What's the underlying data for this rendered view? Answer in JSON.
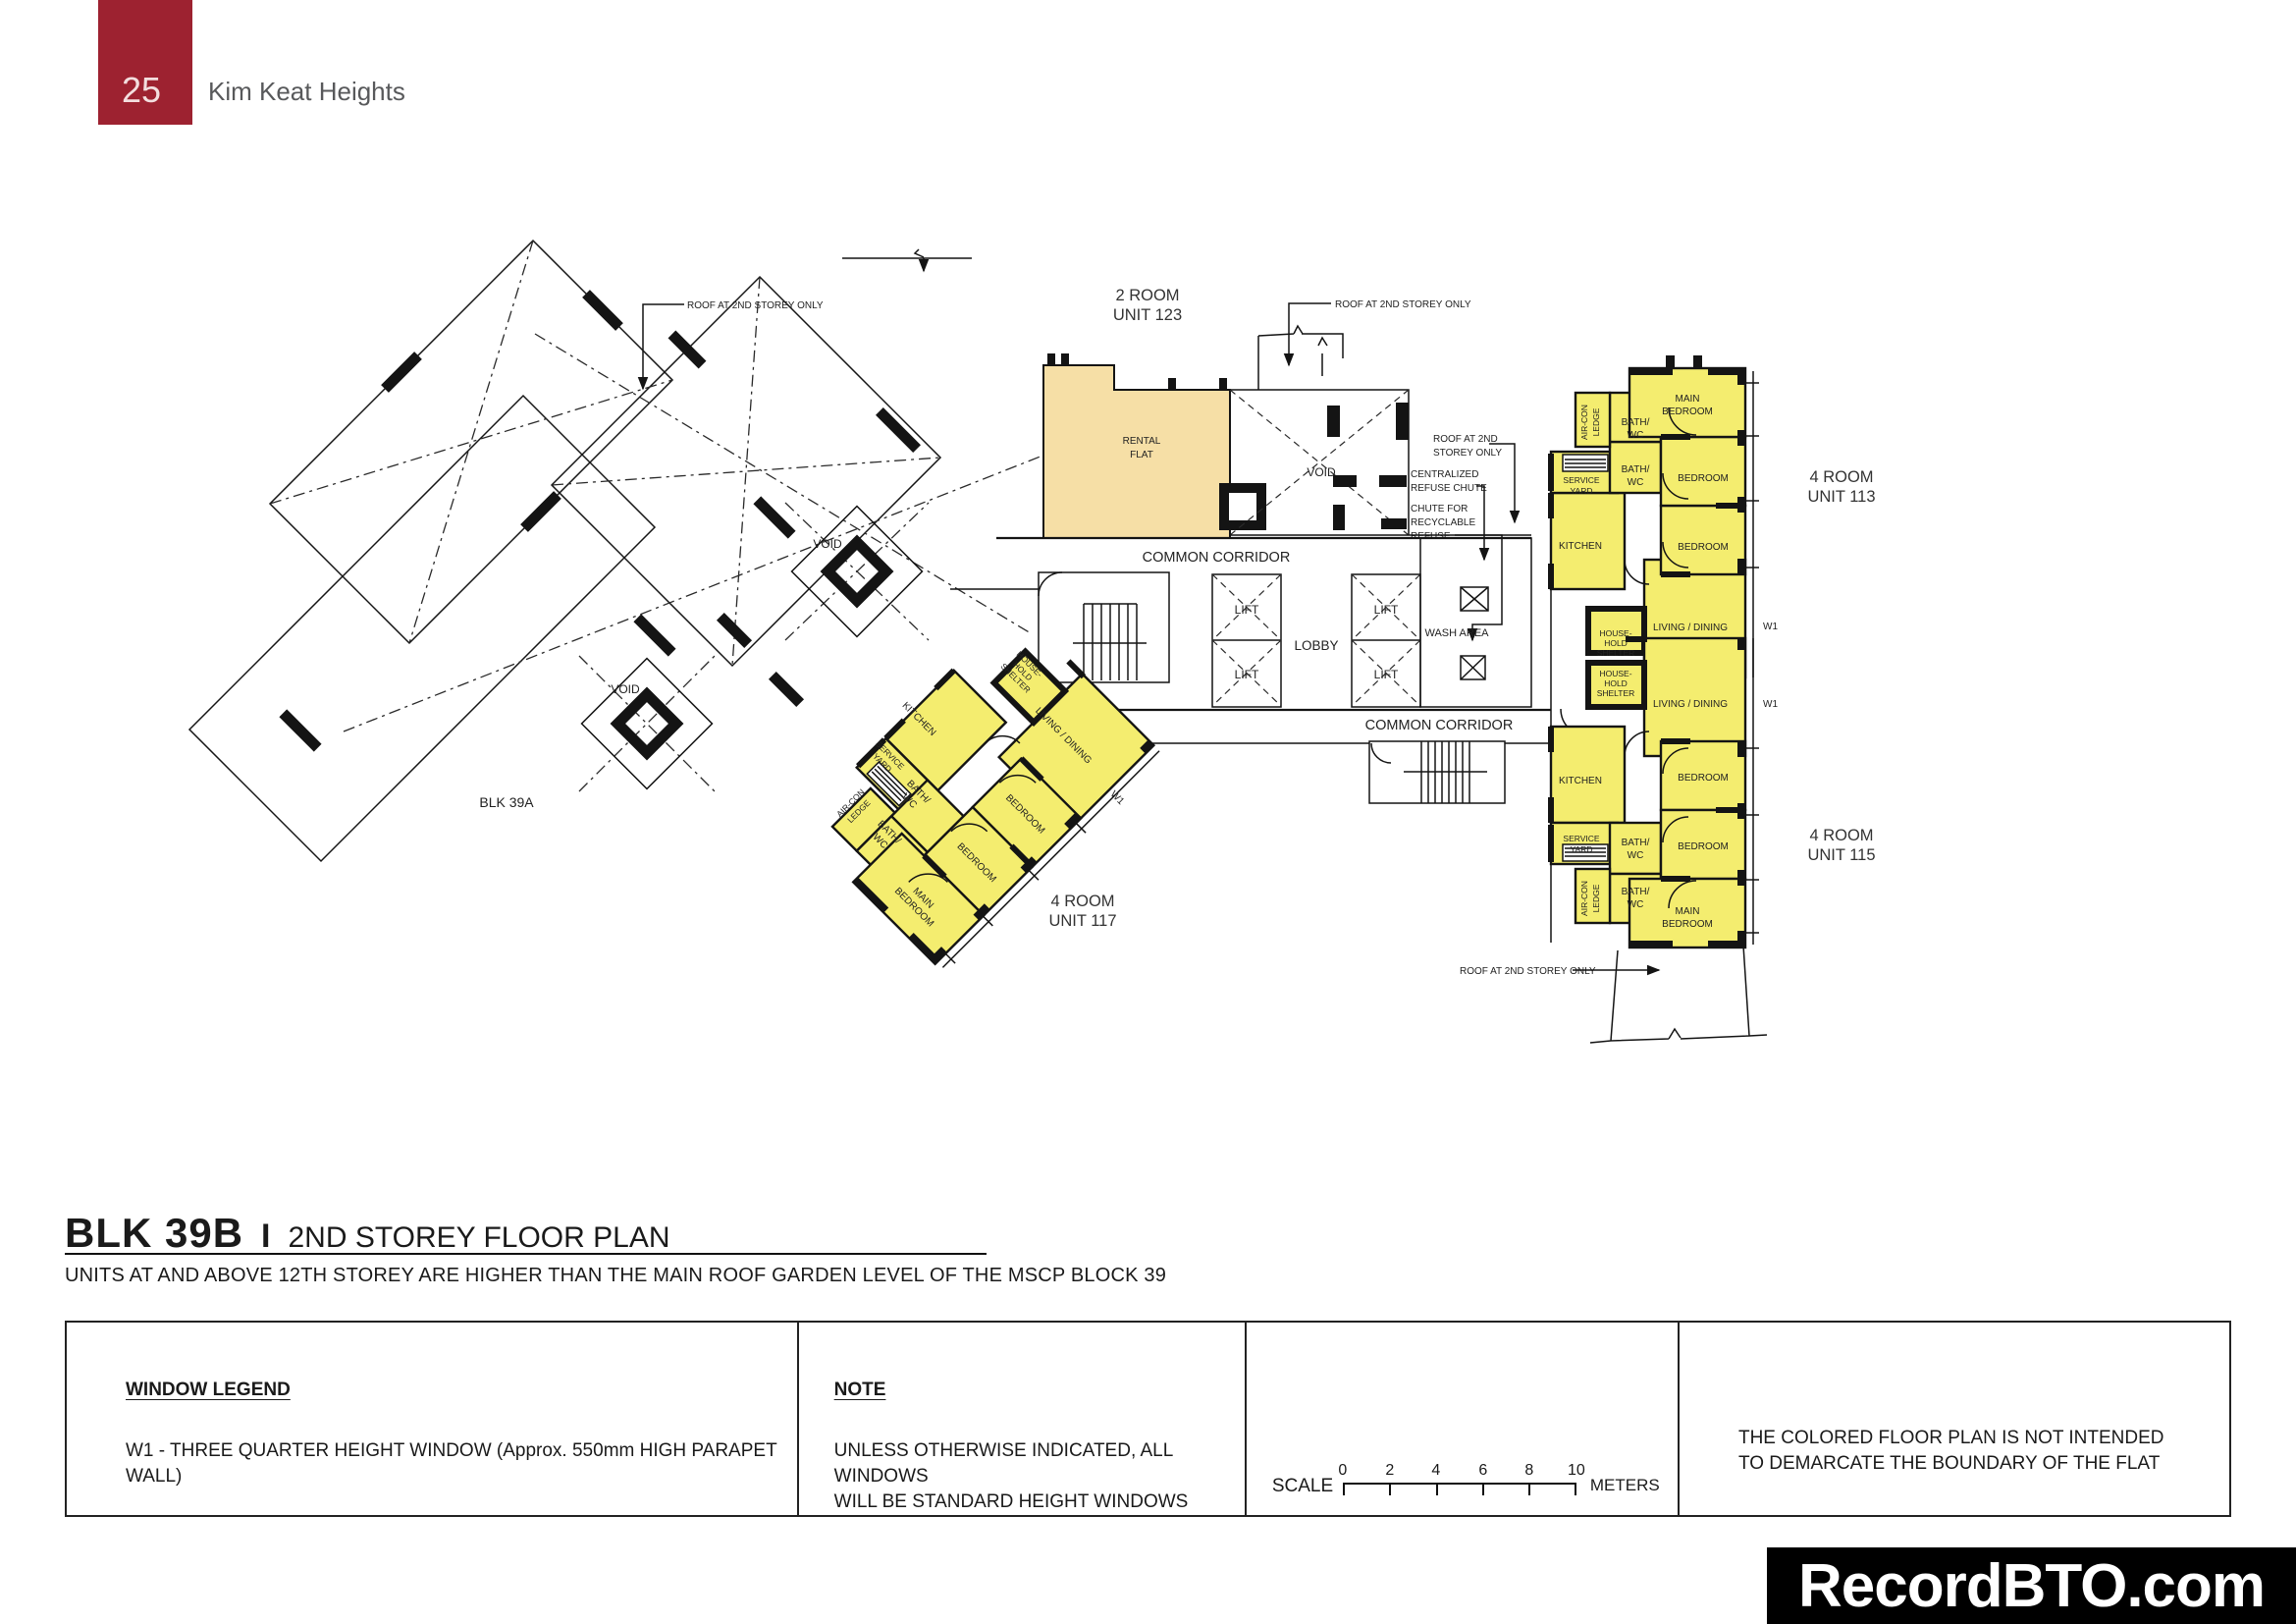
{
  "page": {
    "number": "25",
    "project": "Kim Keat Heights"
  },
  "title": {
    "block": "BLK 39B",
    "separator": "I",
    "storey": "2ND STOREY FLOOR PLAN",
    "note": "UNITS AT AND ABOVE 12TH STOREY ARE HIGHER THAN THE MAIN ROOF GARDEN LEVEL OF THE MSCP BLOCK 39"
  },
  "units": {
    "u123_l1": "2 ROOM",
    "u123_l2": "UNIT 123",
    "u113_l1": "4 ROOM",
    "u113_l2": "UNIT 113",
    "u115_l1": "4 ROOM",
    "u115_l2": "UNIT 115",
    "u117_l1": "4 ROOM",
    "u117_l2": "UNIT 117"
  },
  "rooms": {
    "main_l1": "MAIN",
    "main_l2": "BEDROOM",
    "bedroom": "BEDROOM",
    "bath_l1": "BATH/",
    "bath_l2": "WC",
    "kitchen": "KITCHEN",
    "service_l1": "SERVICE",
    "service_l2": "YARD",
    "aircon_l1": "AIR-CON",
    "aircon_l2": "LEDGE",
    "living": "LIVING / DINING",
    "hhs_l1": "HOUSE-",
    "hhs_l2": "HOLD",
    "hhs_l3": "SHELTER",
    "rental_l1": "RENTAL",
    "rental_l2": "FLAT",
    "w1": "W1"
  },
  "core": {
    "lift": "LIFT",
    "lobby": "LOBBY",
    "wash": "WASH AREA",
    "corridor": "COMMON CORRIDOR",
    "void": "VOID",
    "blk39a": "BLK 39A"
  },
  "ann": {
    "roof": "ROOF AT 2ND STOREY ONLY",
    "roof_l1": "ROOF AT 2ND",
    "roof_l2": "STOREY ONLY",
    "cen_l1": "CENTRALIZED",
    "cen_l2": "REFUSE CHUTE",
    "rec_l1": "CHUTE FOR",
    "rec_l2": "RECYCLABLE",
    "rec_l3": "REFUSE"
  },
  "legend": {
    "window_title": "WINDOW LEGEND",
    "window_body": "W1 - THREE QUARTER HEIGHT WINDOW  (Approx. 550mm HIGH PARAPET WALL)",
    "note_title": "NOTE",
    "note_l1": "UNLESS OTHERWISE INDICATED, ALL WINDOWS",
    "note_l2": "WILL BE STANDARD HEIGHT WINDOWS",
    "scale_label": "SCALE",
    "meters_label": "METERS",
    "ticks": [
      "0",
      "2",
      "4",
      "6",
      "8",
      "10"
    ],
    "disclaimer_l1": "THE COLORED FLOOR PLAN IS NOT INTENDED",
    "disclaimer_l2": "TO DEMARCATE THE BOUNDARY OF THE FLAT"
  },
  "watermark": "RecordBTO.com",
  "colors": {
    "badge_red": "#9d2230",
    "unit_yellow": "#f4ed6f",
    "rental_tan": "#f6dfa6",
    "banner_black": "#000000"
  }
}
